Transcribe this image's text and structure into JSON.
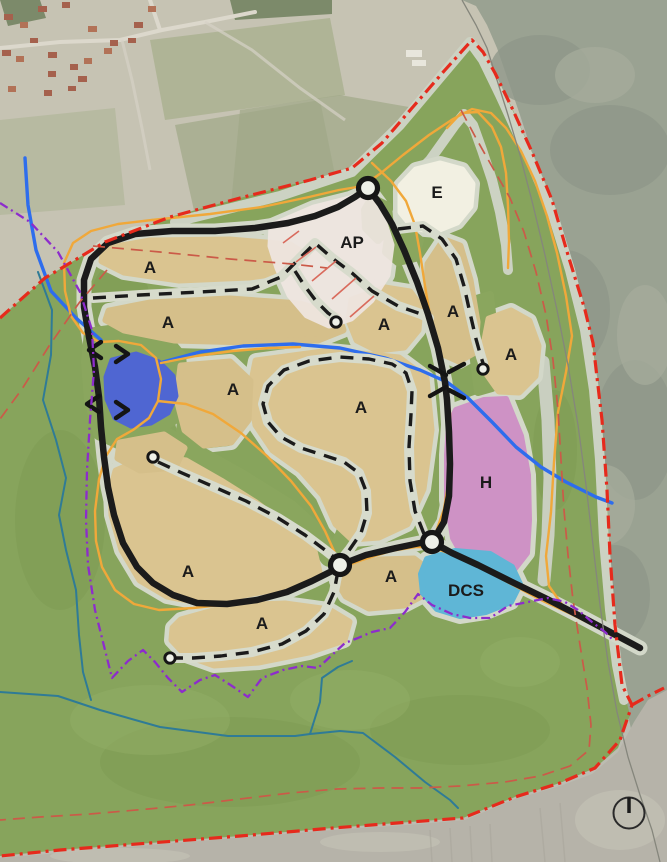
{
  "labels": {
    "a": "A",
    "e": "E",
    "ap": "AP",
    "h": "H",
    "dcs": "DCS"
  },
  "zones": [
    {
      "code": "A",
      "fill": "#dac490",
      "label_count": 10
    },
    {
      "code": "E",
      "fill": "#f2f0e2",
      "label_count": 1
    },
    {
      "code": "AP",
      "fill": "#efe6e1",
      "label_count": 1
    },
    {
      "code": "H",
      "fill": "#ce92c5",
      "label_count": 1
    },
    {
      "code": "DCS",
      "fill": "#5fb6d6",
      "label_count": 1
    }
  ],
  "line_colors": {
    "road": "#1b1b1b",
    "trail": "#1b1b1b",
    "cart_path": "#f0a83a",
    "stream": "#2e6ded",
    "creek": "#2f7b96",
    "site_boundary": "#e62a1c",
    "secondary_boundary": "#cb5a48",
    "protection_boundary": "#8d2ccc"
  },
  "area_colors": {
    "fairway_green": "#87a45c",
    "corridor": "#d3d8c9",
    "pond": "#4f66d2"
  },
  "symbols": {
    "north_indicator": "north-arrow-icon",
    "road_node": "circle-node",
    "trail_end": "circle-terminus",
    "stream_crossing": "culvert-marks"
  }
}
